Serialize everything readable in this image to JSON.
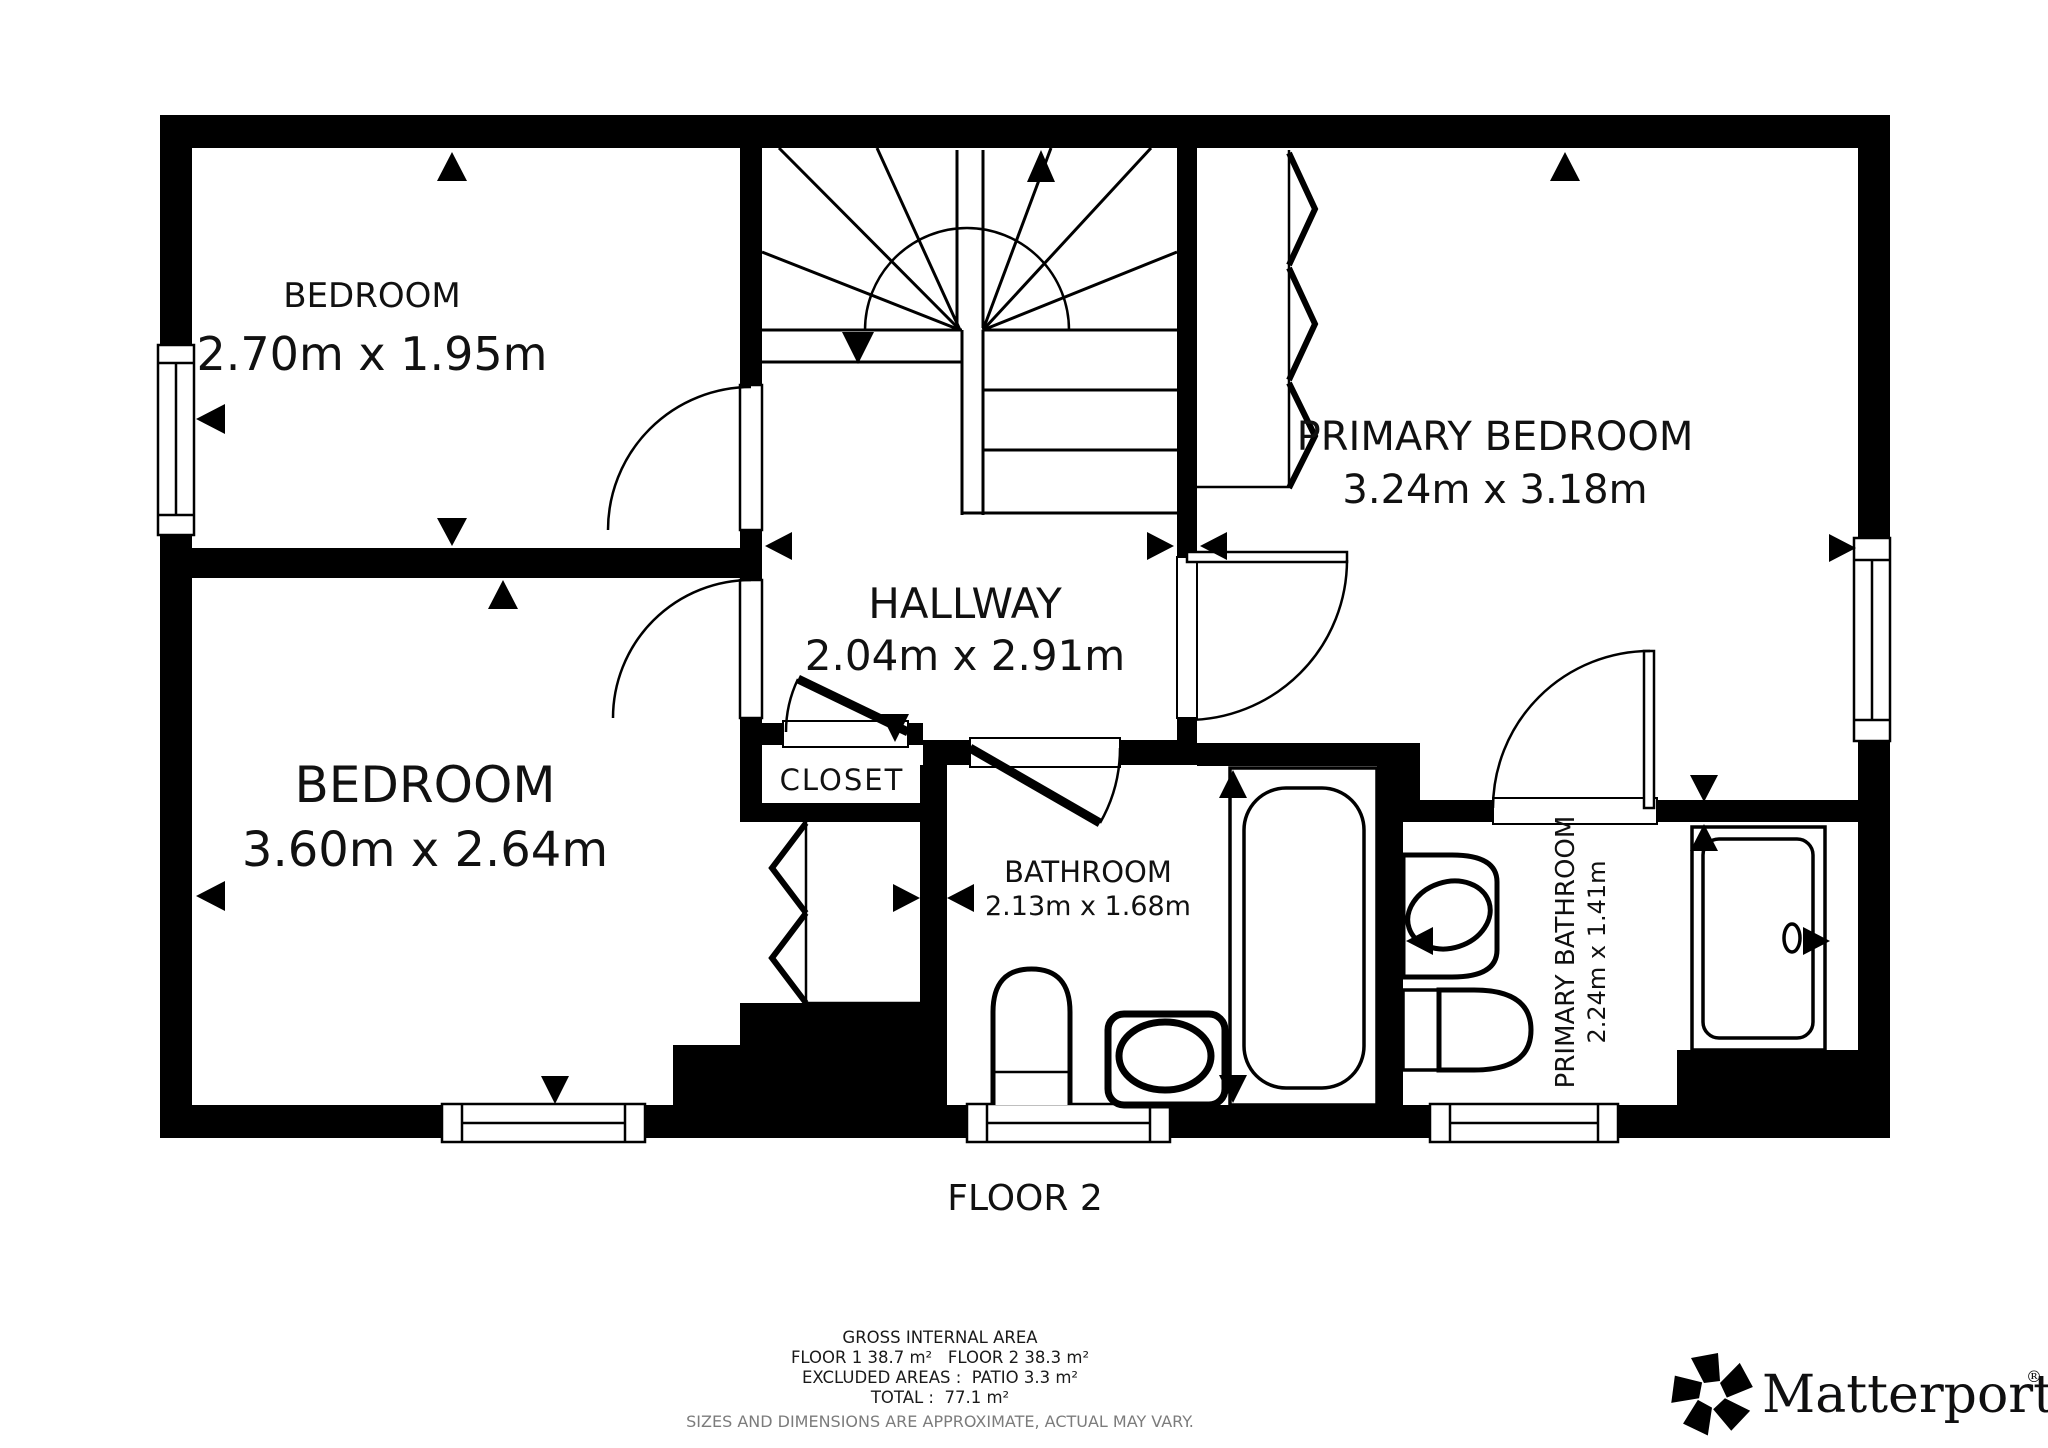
{
  "page": {
    "background": "#ffffff",
    "type": "floor-plan"
  },
  "floor": {
    "label": "FLOOR 2"
  },
  "rooms": {
    "bedroom_top": {
      "name": "BEDROOM",
      "dims": "2.70m x 1.95m"
    },
    "bedroom_bottom": {
      "name": "BEDROOM",
      "dims": "3.60m x 2.64m"
    },
    "hallway": {
      "name": "HALLWAY",
      "dims": "2.04m x 2.91m"
    },
    "primary_bedroom": {
      "name": "PRIMARY BEDROOM",
      "dims": "3.24m x 3.18m"
    },
    "closet": {
      "name": "CLOSET"
    },
    "bathroom": {
      "name": "BATHROOM",
      "dims": "2.13m x 1.68m"
    },
    "primary_bathroom": {
      "name": "PRIMARY BATHROOM",
      "dims": "2.24m x 1.41m"
    }
  },
  "footer": {
    "title": "GROSS INTERNAL AREA",
    "floors": "FLOOR 1 38.7 m²   FLOOR 2 38.3 m²",
    "excluded": "EXCLUDED AREAS :  PATIO 3.3 m²",
    "total": "TOTAL :  77.1 m²",
    "disclaimer": "SIZES AND DIMENSIONS ARE APPROXIMATE, ACTUAL MAY VARY."
  },
  "brand": {
    "name": "Matterport",
    "registered": "®",
    "icon": "matterport-pinwheel-icon"
  },
  "colors": {
    "wall": "#000000",
    "background": "#ffffff",
    "label_text": "#111111",
    "footer_text": "#1a1a1a",
    "disclaimer_text": "#7c7c7c"
  }
}
